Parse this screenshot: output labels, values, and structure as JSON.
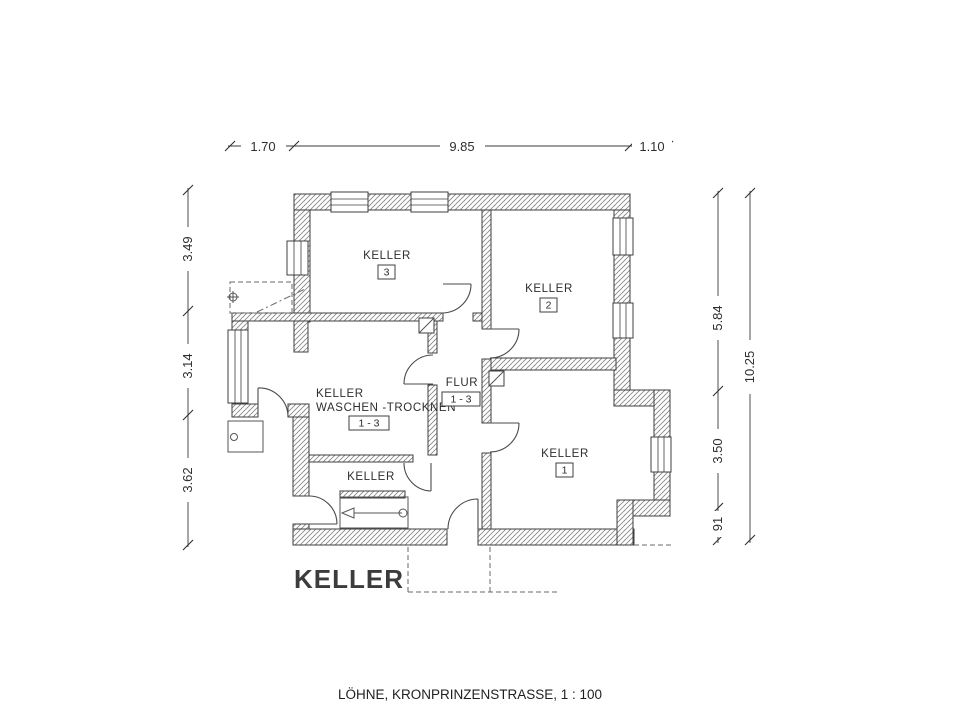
{
  "plan": {
    "big_title": "KELLER",
    "caption": "LÖHNE, KRONPRINZENSTRASSE, 1 : 100"
  },
  "rooms": {
    "keller_3": {
      "label": "KELLER",
      "number": "3"
    },
    "keller_2": {
      "label": "KELLER",
      "number": "2"
    },
    "keller_1": {
      "label": "KELLER",
      "number": "1"
    },
    "keller_waschen": {
      "label_line1": "KELLER",
      "label_line2": "WASCHEN -TROCKNEN",
      "number": "1 - 3"
    },
    "flur": {
      "label": "FLUR",
      "number": "1 - 3"
    },
    "keller_under_stair": {
      "label": "KELLER"
    }
  },
  "dimensions": {
    "top": {
      "d1": "1.70",
      "d2": "9.85",
      "d3": "1.10"
    },
    "left": {
      "d1": "3.49",
      "d2": "3.14",
      "d3": "3.62"
    },
    "right_inner": {
      "d1": "5.84",
      "d2": "3.50",
      "d3": "91"
    },
    "right_outer": {
      "d1": "10.25"
    }
  },
  "colors": {
    "line": "#3f3f3f",
    "hatch": "#8a8a8a",
    "text": "#2e2e2e",
    "background": "#ffffff"
  }
}
